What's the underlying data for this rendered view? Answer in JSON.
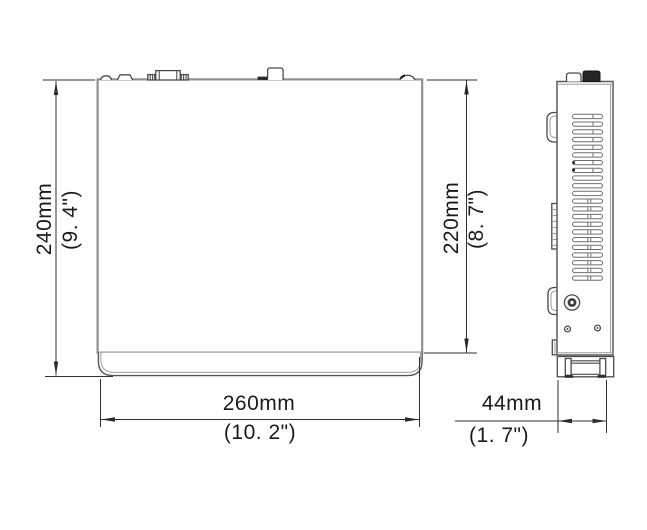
{
  "drawing": {
    "dimensions": {
      "overall_height": {
        "mm": "240mm",
        "inch": "(9. 4\")"
      },
      "body_height": {
        "mm": "220mm",
        "inch": "(8. 7\")"
      },
      "width": {
        "mm": "260mm",
        "inch": "(10. 2\")"
      },
      "depth": {
        "mm": "44mm",
        "inch": "(1. 7\")"
      }
    },
    "colors": {
      "background": "#ffffff",
      "outline": "#8f8f8f",
      "detail_line": "#4a4a4a",
      "dimension_line": "#2f2f2f",
      "text": "#1a1a1a"
    }
  }
}
